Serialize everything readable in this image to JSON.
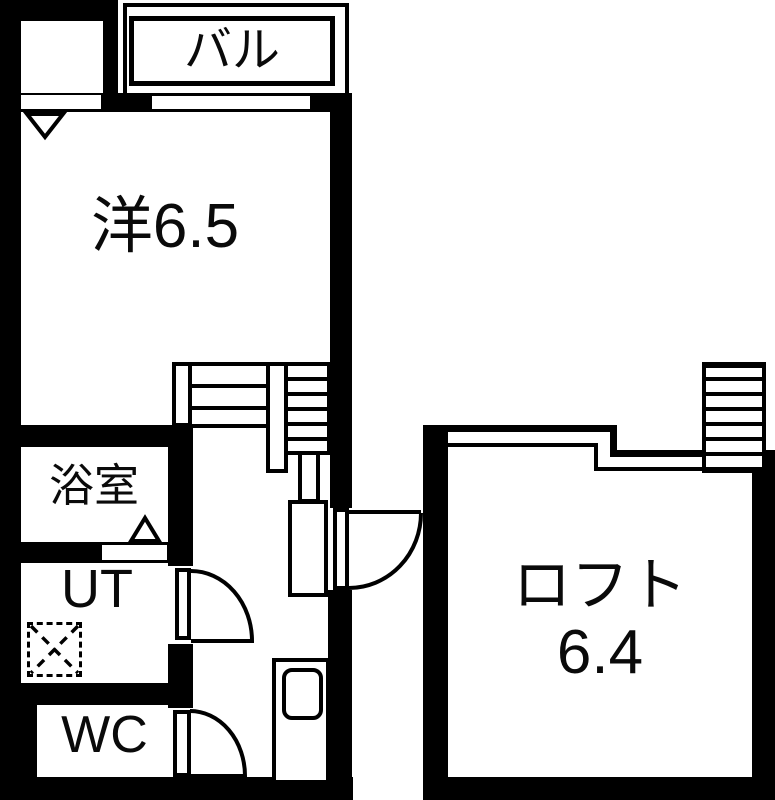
{
  "plan": {
    "rooms": {
      "living": {
        "label": "洋6.5"
      },
      "balcony": {
        "label": "バル"
      },
      "bathroom": {
        "label": "浴室"
      },
      "utility": {
        "label": "UT"
      },
      "toilet": {
        "label": "WC"
      },
      "loft": {
        "label": "ロフト",
        "size": "6.4"
      }
    },
    "features": {
      "staircase": "staircase",
      "loft_ladder": "ladder",
      "washer_space": "dashed washing-machine space",
      "sink": "kitchen sink",
      "doors": [
        "entrance-door",
        "ut-door",
        "wc-door",
        "bathroom-folding-door"
      ]
    },
    "colors": {
      "wall": "#000000",
      "background": "#ffffff",
      "line": "#000000",
      "text": "#0a0a0a"
    }
  }
}
